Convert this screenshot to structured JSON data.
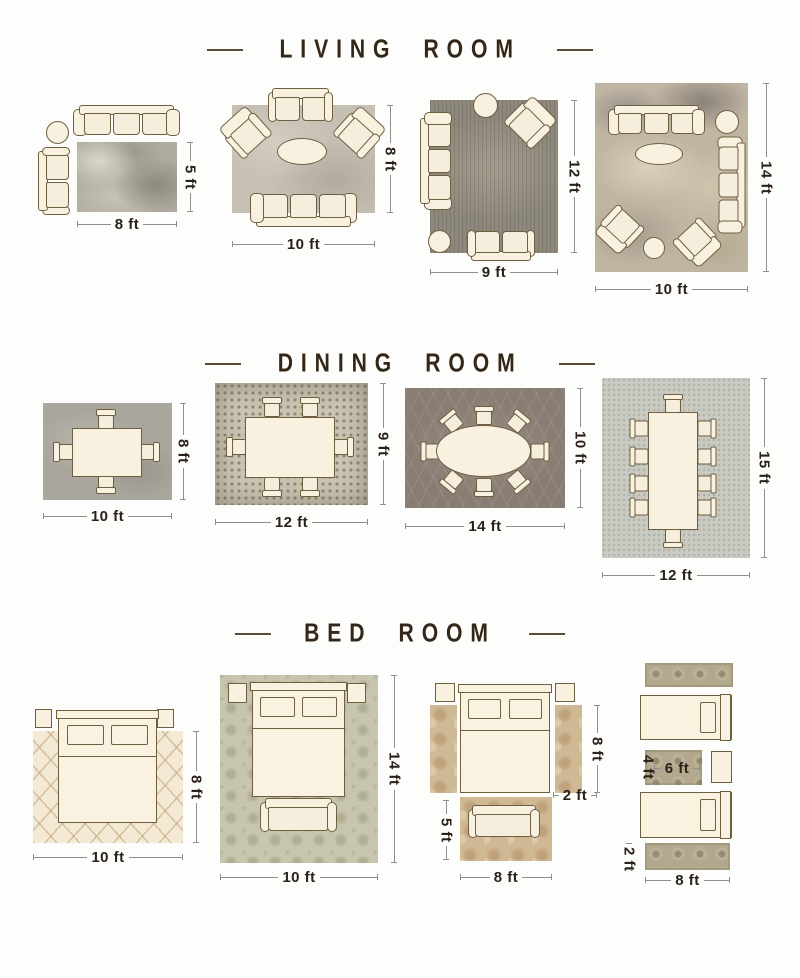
{
  "palette": {
    "background": "#fdfdfb",
    "title_text": "#342718",
    "dimension_text": "#2b2118",
    "dimension_line": "#8f8f8f",
    "furniture_fill": "#f8f1e0",
    "furniture_outline": "#6e5f41"
  },
  "sections": [
    {
      "title": "LIVING ROOM",
      "layouts": [
        {
          "width_label": "8 ft",
          "height_label": "5 ft"
        },
        {
          "width_label": "10 ft",
          "height_label": "8 ft"
        },
        {
          "width_label": "9 ft",
          "height_label": "12 ft"
        },
        {
          "width_label": "10 ft",
          "height_label": "14 ft"
        }
      ]
    },
    {
      "title": "DINING ROOM",
      "layouts": [
        {
          "width_label": "10 ft",
          "height_label": "8 ft"
        },
        {
          "width_label": "12 ft",
          "height_label": "9 ft"
        },
        {
          "width_label": "14 ft",
          "height_label": "10 ft"
        },
        {
          "width_label": "12 ft",
          "height_label": "15 ft"
        }
      ]
    },
    {
      "title": "BED ROOM",
      "layouts": [
        {
          "width_label": "10 ft",
          "height_label": "8 ft"
        },
        {
          "width_label": "10 ft",
          "height_label": "14 ft"
        },
        {
          "side_runner_length_label": "8 ft",
          "side_runner_width_label": "2 ft",
          "foot_rug_height_label": "5 ft",
          "foot_rug_width_label": "8 ft"
        },
        {
          "small_rug_height_label": "4 ft",
          "small_rug_width_label": "6 ft",
          "runner_width_label": "2 ft",
          "runner_length_label": "8 ft"
        }
      ]
    }
  ]
}
